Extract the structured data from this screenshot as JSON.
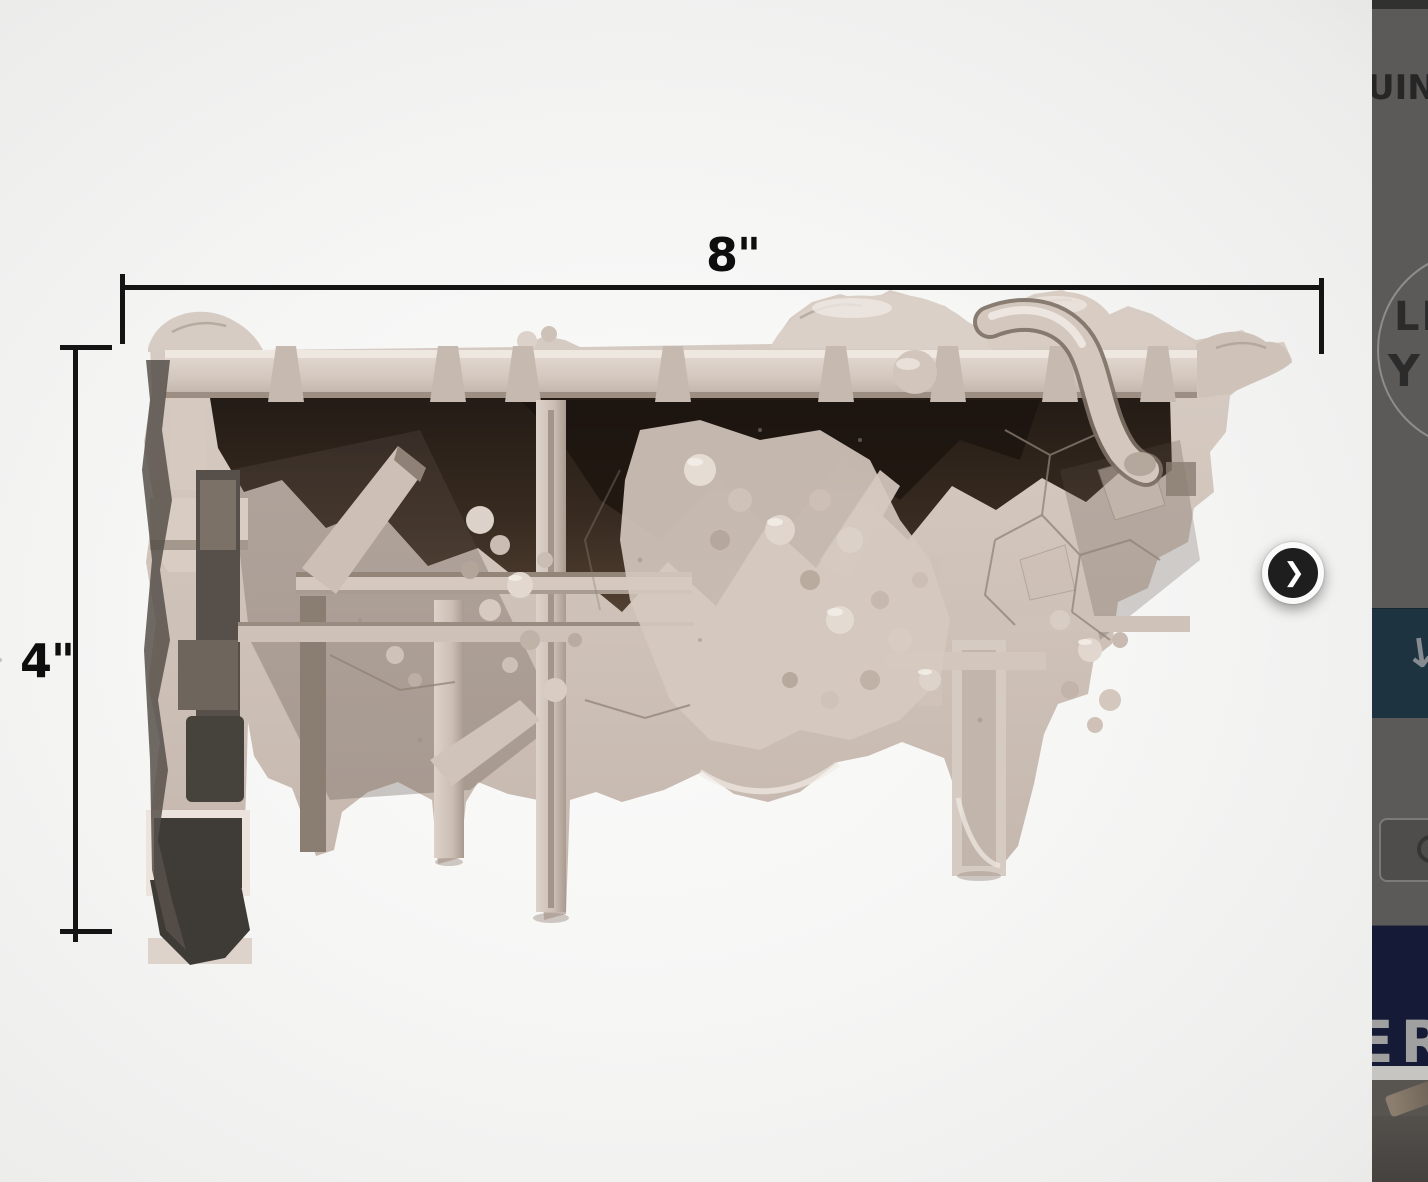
{
  "viewer": {
    "dimension_width": "8\"",
    "dimension_height": "4\"",
    "model_alt": "ruined-wall-3d-render"
  },
  "icons": {
    "next": "❯",
    "download": "↓"
  },
  "side_panel": {
    "heading_fragment": "UIN",
    "logo_line1": "LI",
    "logo_line2": "Y",
    "banner_fragment": "ER",
    "colors": {
      "panel_gray": "#5b5a58",
      "download_tile_blue": "#1e3340",
      "banner_navy": "#151b36",
      "banner_text_gray": "#a0a0a0",
      "divider_strip": "#c7c5c1"
    }
  },
  "accents": {
    "dimension_line": "#141414",
    "next_button_fill": "#1e1e1e",
    "next_button_ring": "#fafafa",
    "model_stone_light": "#d8cdc5",
    "model_shadow_brown": "#241a12"
  }
}
